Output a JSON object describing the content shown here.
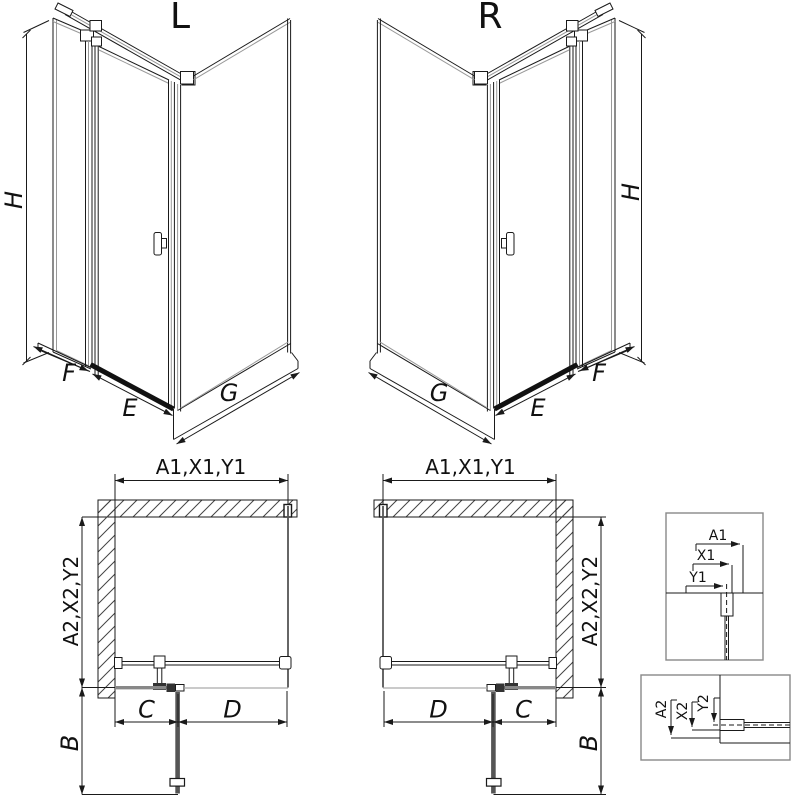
{
  "iso_left": {
    "title": "L",
    "h": "H",
    "f": "F",
    "e": "E",
    "g": "G"
  },
  "iso_right": {
    "title": "R",
    "h": "H",
    "f": "F",
    "e": "E",
    "g": "G"
  },
  "plan_left": {
    "top": "A1,X1,Y1",
    "side": "A2,X2,Y2",
    "c": "C",
    "d": "D",
    "b": "B"
  },
  "plan_right": {
    "top": "A1,X1,Y1",
    "side": "A2,X2,Y2",
    "c": "C",
    "d": "D",
    "b": "B"
  },
  "detail_top": {
    "a1": "A1",
    "x1": "X1",
    "y1": "Y1"
  },
  "detail_bottom": {
    "a2": "A2",
    "x2": "X2",
    "y2": "Y2"
  },
  "colors": {
    "line": "#1a1a1a",
    "glass": "#999999",
    "door": "#555555",
    "hatch": "#444444",
    "background": "#ffffff"
  }
}
